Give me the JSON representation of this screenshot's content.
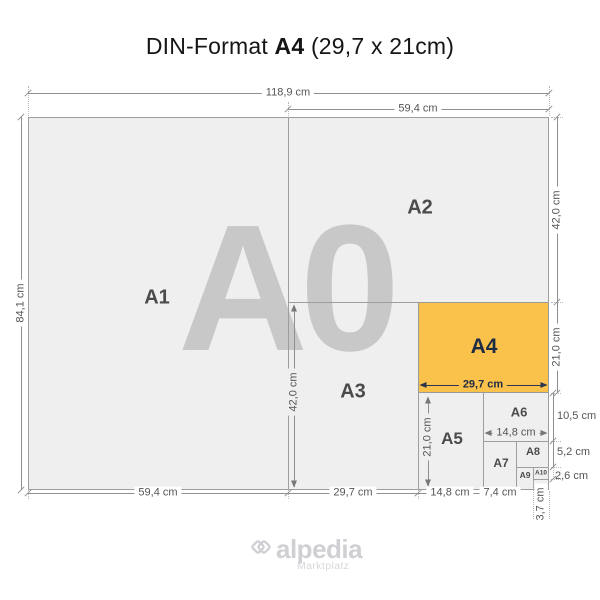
{
  "title": {
    "prefix": "DIN-Format ",
    "format": "A4",
    "size": " (29,7 x 21cm)"
  },
  "papers": {
    "a0": "A0",
    "a1": "A1",
    "a2": "A2",
    "a3": "A3",
    "a4": "A4",
    "a5": "A5",
    "a6": "A6",
    "a7": "A7",
    "a8": "A8",
    "a9": "A9",
    "a10": "A10"
  },
  "dims": {
    "total_width": "118,9 cm",
    "a2_width": "59,4 cm",
    "total_height": "84,1 cm",
    "a2_height": "42,0 cm",
    "a4_height_right": "21,0 cm",
    "a6_height_right": "10,5 cm",
    "a8_height_right": "5,2 cm",
    "a10_height_right": "2,6 cm",
    "a1_width": "59,4 cm",
    "a3_width_bottom": "29,7 cm",
    "a5_width_bottom": "14,8 cm",
    "a7_width_bottom": "7,4 cm",
    "a9_width_bottom": "3,7 cm",
    "a3_height": "42,0 cm",
    "a4_width": "29,7 cm",
    "a5_height": "21,0 cm",
    "a6_width": "14,8 cm"
  },
  "colors": {
    "accent": "#fac24b",
    "accent_text": "#1d2b45",
    "paper": "#efefef",
    "watermark": "#c8c8c8",
    "line": "#9e9e9e",
    "dim_text": "#555555",
    "logo": "#d0d0d4"
  },
  "logo": {
    "name": "alpedia",
    "tagline": "Marktplatz"
  }
}
